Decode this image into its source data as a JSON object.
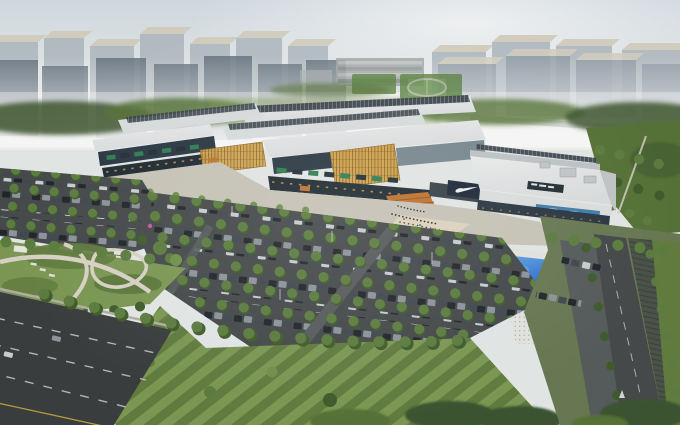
{
  "meta": {
    "title": "Aerial architectural rendering of an outlet mall complex",
    "description": "Bird's-eye rendering of a long low-rise retail mall with layered white roofs and dark skylight monitors, golden timber-lattice facade features, a band of green tenant signs, a Nike storefront with white swoosh logo, an illegible rooftop brand sign, a teal mosaic glass band, a bright blue swimming-pool water feature with patterned walkway, a landscaped park with curved cream paths, vast tree-lined surface parking lots full of cars, boulevard roads with lane markings, and a hazy high-rise city skyline under a pale misty sky."
  },
  "scene": {
    "landmarks": [
      {
        "label": "hazy high-rise skyline"
      },
      {
        "label": "retail mall with rooftop skylight monitors"
      },
      {
        "label": "nike storefront with swoosh logo"
      },
      {
        "label": "illegible rooftop brand sign"
      },
      {
        "label": "golden timber lattice facade panels"
      },
      {
        "label": "green tenant signage band"
      },
      {
        "label": "blue swimming pool water feature"
      },
      {
        "label": "patterned pedestrian walkway with canopy"
      },
      {
        "label": "tree-lined surface parking lots"
      },
      {
        "label": "landscaped park with curved paths"
      },
      {
        "label": "boulevard with lane markings"
      },
      {
        "label": "sports fields with running track"
      }
    ],
    "signage": {
      "nike_swoosh": "white swoosh glyph on dark navy panel (no text)",
      "tenant_signs": "alternating green and dark logo panels, illegible",
      "rooftop_sign": "dark panel with small illegible white lettering"
    }
  },
  "palette": {
    "sky-top": "#d5dfe6",
    "sky-horizon": "#f2f3f0",
    "sun-haze": "#ffffff",
    "tower-top": "#d8d3c3",
    "tower-face-light": "#b7c0c7",
    "tower-face": "#93a0aa",
    "tower-face-dark": "#62717e",
    "green-dark": "#3e5730",
    "green-mid": "#587539",
    "green-light": "#74944c",
    "field-green": "#5d8742",
    "lawn-light": "#7f9c55",
    "lawn-mid": "#647f40",
    "tree-green": "#5e8040",
    "tree-shade": "#415e2c",
    "roof-white": "#f1f2f2",
    "roof-light": "#dfe2e3",
    "roof-mid": "#c3c8cb",
    "roof-dark": "#363e46",
    "rib-line": "#717b84",
    "facade-glass": "#2b3844",
    "facade-shadow": "#202b33",
    "facade-warm": "#d49a55",
    "lattice-gold": "#d8a851",
    "lattice-dark": "#8a6420",
    "sign-green": "#2f8252",
    "sign-dark": "#232f37",
    "nike-navy": "#1c2a38",
    "swoosh-white": "#f6f8f9",
    "mosaic-teal": "#4381ad",
    "mosaic-light": "#a6cde0",
    "pool-blue": "#1d64cc",
    "pool-light": "#6fb0ee",
    "deck-white": "#e9eae4",
    "plaza": "#cdc9bc",
    "plaza-warm": "#e6dcc4",
    "stair-orange": "#c5762f",
    "stair-line": "#9c5a20",
    "asphalt": "#474b4c",
    "asphalt-dark": "#3b3f40",
    "drive-gray": "#585d5d",
    "lane-white": "#cdd1d1",
    "lane-yellow": "#c0a23e",
    "car-dark": "#21262b",
    "car-mid": "#424a52",
    "car-light": "#9198a0",
    "car-white": "#ced3d7",
    "path-cream": "#ddd8c9",
    "shed-gray": "#a9aeae",
    "hatch-green": "#49524b",
    "accent-pink": "#c95ba6",
    "crowd-dark": "#35302b"
  }
}
